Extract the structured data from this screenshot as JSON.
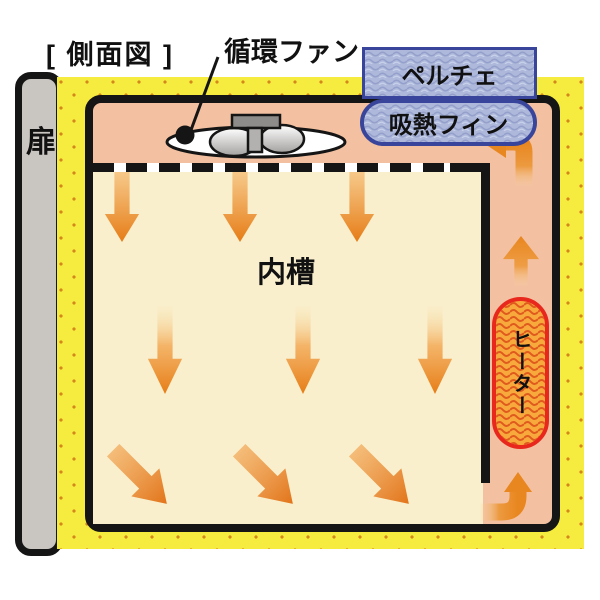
{
  "figure": {
    "view_title": "[ 側面図 ]",
    "subject": "恒温槽内の空気循環図"
  },
  "labels": {
    "view_title": "[ 側面図 ]",
    "circulation_fan": "循環ファン",
    "peltier": "ペルチェ",
    "heat_absorb_fin": "吸熱フィン",
    "inner_tank": "内槽",
    "heater": "ヒーター",
    "door": "扉"
  },
  "colors": {
    "insulation_yellow": "#f6ec3f",
    "insulation_dots": "#d4881c",
    "chamber_pink": "#f3c1a1",
    "inner_tank_cream": "#f9efcc",
    "arrow_orange": "#e8861f",
    "peltier_fill": "#aeb8da",
    "peltier_border": "#39459a",
    "heater_fill": "#f8a93c",
    "heater_border": "#e8281c",
    "door_gray": "#c9c5c1",
    "wall_black": "#151515"
  },
  "airflow_arrows": {
    "tank_top_row": {
      "count": 3,
      "direction": "down"
    },
    "tank_middle_row": {
      "count": 3,
      "direction": "down"
    },
    "tank_bottom_row": {
      "count": 3,
      "direction": "down-right"
    },
    "right_duct": {
      "count": 1,
      "direction": "up"
    },
    "top_corner_turn": {
      "count": 1,
      "direction": "up then left toward fin"
    },
    "bottom_corner_turn": {
      "count": 1,
      "direction": "right then up into duct"
    }
  }
}
